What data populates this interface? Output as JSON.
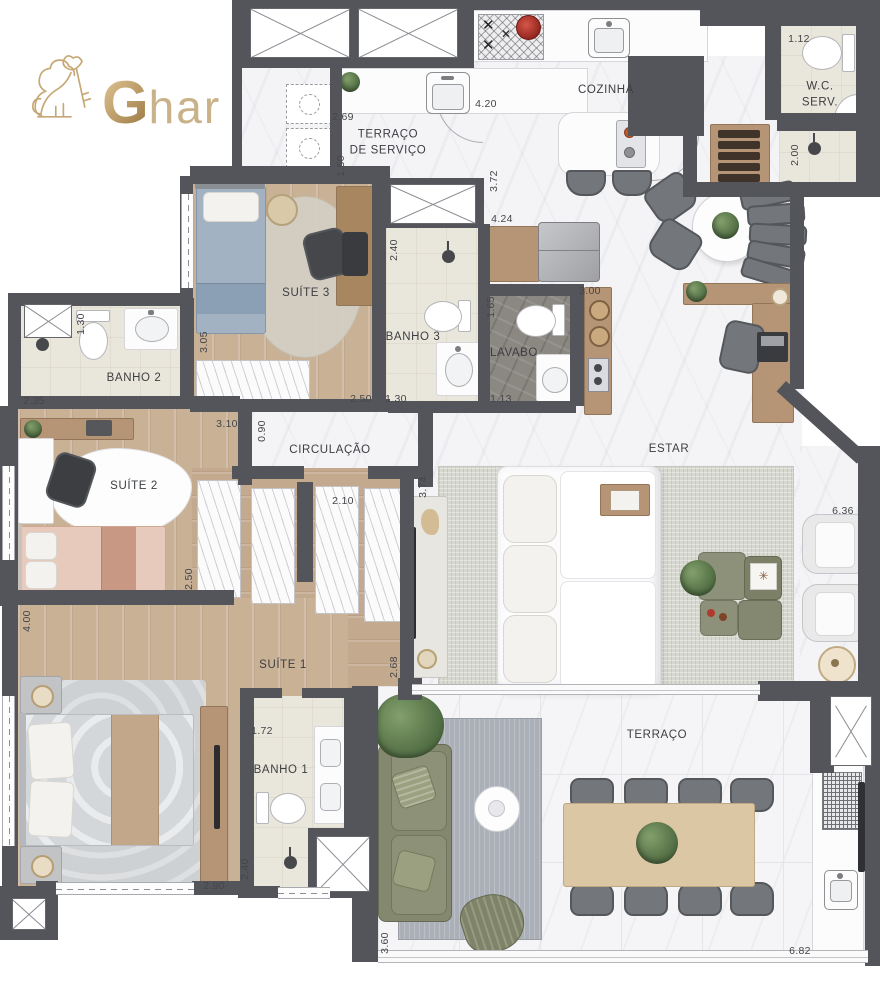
{
  "logo": {
    "brand_g": "G",
    "brand_rest": "har",
    "lion_icon": "lion-with-key-icon"
  },
  "colors": {
    "wall": "#54555A",
    "gold": "#C3A572",
    "wood": "#C9B196",
    "marble": "#F4F4F6",
    "sofa_green": "#868A6F",
    "accent_red": "#B93A31"
  },
  "floorplan": {
    "rooms": [
      {
        "id": "cozinha",
        "label": "COZINHA",
        "x": 606,
        "y": 91
      },
      {
        "id": "wc-serv",
        "label": "W.C.\nSERV.",
        "x": 820,
        "y": 95
      },
      {
        "id": "terraco-servico",
        "label": "TERRAÇO\nDE SERVIÇO",
        "x": 388,
        "y": 143
      },
      {
        "id": "suite3",
        "label": "SUÍTE 3",
        "x": 306,
        "y": 294
      },
      {
        "id": "banho3",
        "label": "BANHO 3",
        "x": 413,
        "y": 338
      },
      {
        "id": "lavabo",
        "label": "LAVABO",
        "x": 514,
        "y": 354
      },
      {
        "id": "banho2",
        "label": "BANHO 2",
        "x": 134,
        "y": 379
      },
      {
        "id": "circulacao",
        "label": "CIRCULAÇÃO",
        "x": 330,
        "y": 451
      },
      {
        "id": "estar",
        "label": "ESTAR",
        "x": 669,
        "y": 450
      },
      {
        "id": "suite2",
        "label": "SUÍTE 2",
        "x": 134,
        "y": 487
      },
      {
        "id": "suite1",
        "label": "SUÍTE 1",
        "x": 283,
        "y": 666
      },
      {
        "id": "banho1",
        "label": "BANHO 1",
        "x": 281,
        "y": 771
      },
      {
        "id": "terraco",
        "label": "TERRAÇO",
        "x": 657,
        "y": 736
      }
    ],
    "dimensions": [
      {
        "v": "1.12",
        "x": 799,
        "y": 39,
        "r": 0
      },
      {
        "v": "2.00",
        "x": 795,
        "y": 155,
        "r": 1
      },
      {
        "v": "2.69",
        "x": 343,
        "y": 117,
        "r": 0
      },
      {
        "v": "1.50",
        "x": 341,
        "y": 166,
        "r": 1
      },
      {
        "v": "4.20",
        "x": 486,
        "y": 104,
        "r": 0
      },
      {
        "v": "3.72",
        "x": 494,
        "y": 181,
        "r": 1
      },
      {
        "v": "4.24",
        "x": 502,
        "y": 219,
        "r": 0
      },
      {
        "v": "2.40",
        "x": 394,
        "y": 250,
        "r": 1
      },
      {
        "v": "3.00",
        "x": 590,
        "y": 291,
        "r": 0
      },
      {
        "v": "1.65",
        "x": 491,
        "y": 307,
        "r": 1
      },
      {
        "v": "1.30",
        "x": 81,
        "y": 324,
        "r": 1
      },
      {
        "v": "2.35",
        "x": 34,
        "y": 401,
        "r": 0
      },
      {
        "v": "3.05",
        "x": 204,
        "y": 342,
        "r": 1
      },
      {
        "v": "2.50",
        "x": 361,
        "y": 399,
        "r": 0
      },
      {
        "v": "1.30",
        "x": 396,
        "y": 399,
        "r": 0
      },
      {
        "v": "1.13",
        "x": 501,
        "y": 399,
        "r": 0
      },
      {
        "v": "3.10",
        "x": 227,
        "y": 424,
        "r": 0
      },
      {
        "v": "0.90",
        "x": 262,
        "y": 431,
        "r": 1
      },
      {
        "v": "2.10",
        "x": 343,
        "y": 501,
        "r": 0
      },
      {
        "v": "3.74",
        "x": 423,
        "y": 487,
        "r": 1
      },
      {
        "v": "2.50",
        "x": 189,
        "y": 579,
        "r": 1
      },
      {
        "v": "4.00",
        "x": 27,
        "y": 621,
        "r": 1
      },
      {
        "v": "2.68",
        "x": 394,
        "y": 667,
        "r": 1
      },
      {
        "v": "6.36",
        "x": 843,
        "y": 511,
        "r": 0
      },
      {
        "v": "1.72",
        "x": 262,
        "y": 731,
        "r": 0
      },
      {
        "v": "2.40",
        "x": 245,
        "y": 869,
        "r": 1
      },
      {
        "v": "2.90",
        "x": 214,
        "y": 886,
        "r": 0
      },
      {
        "v": "3.60",
        "x": 385,
        "y": 943,
        "r": 1
      },
      {
        "v": "6.82",
        "x": 800,
        "y": 951,
        "r": 0
      }
    ]
  }
}
